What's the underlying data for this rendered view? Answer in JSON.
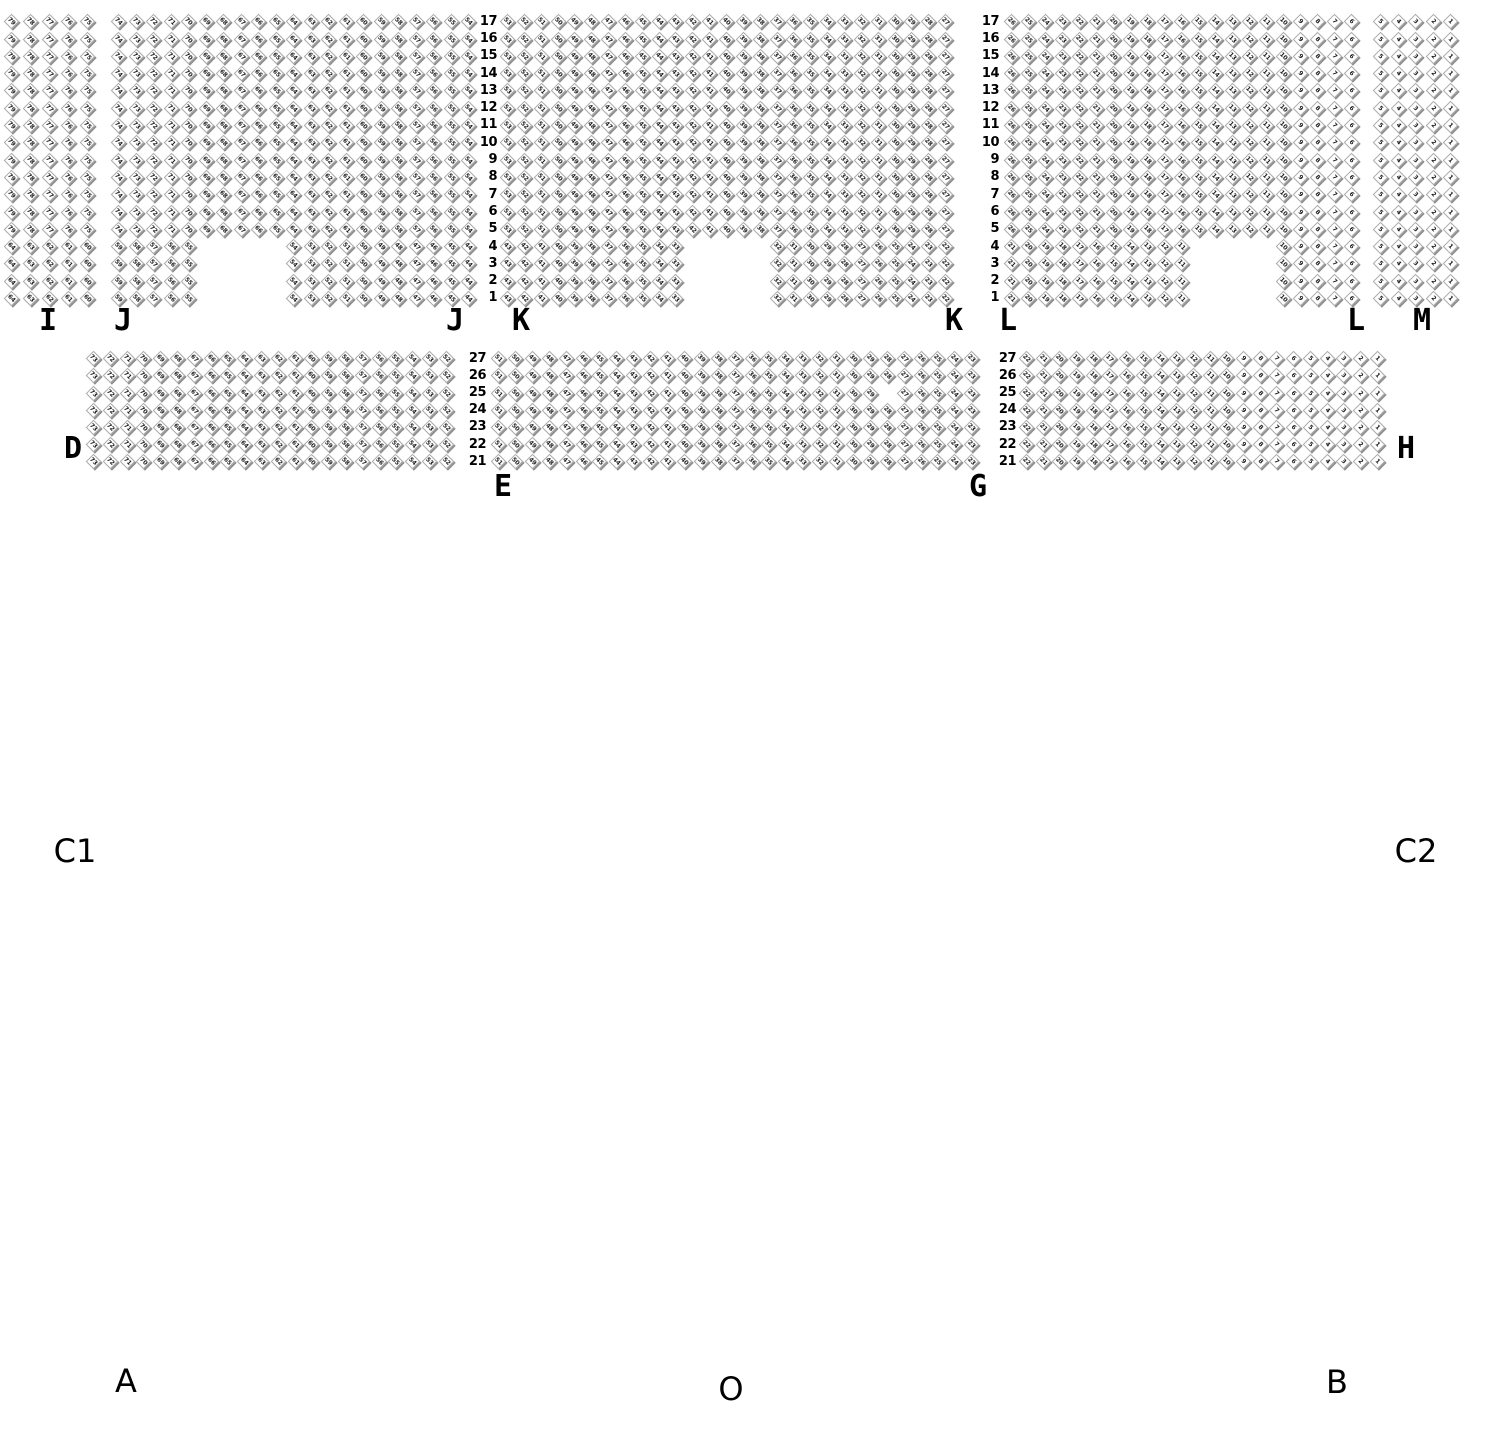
{
  "canvas": {
    "width": 1490,
    "height": 1430,
    "background": "#ffffff"
  },
  "seat_style": {
    "fill": "#ffffff",
    "border_color": "#ababab",
    "shadow_color": "#8f8f8f",
    "number_color": "#1c1c1c"
  },
  "groups": [
    {
      "name": "upper-tier",
      "top": 13,
      "cell_h": 17.3,
      "row_labels": [
        17,
        16,
        15,
        14,
        13,
        12,
        11,
        10,
        9,
        8,
        7,
        6,
        5,
        4,
        3,
        2,
        1
      ],
      "label_columns": [
        {
          "right": 497
        },
        {
          "right": 999
        }
      ],
      "blocks": [
        {
          "name": "I",
          "left": 2,
          "cell_w": 19.0,
          "cols": 5,
          "plans": [
            {
              "rows": [
                17,
                5
              ],
              "segments": [
                [
                  1,
                  79,
                  5
                ]
              ]
            },
            {
              "rows": [
                4,
                1
              ],
              "segments": [
                [
                  1,
                  64,
                  5
                ]
              ]
            }
          ]
        },
        {
          "name": "J",
          "left": 110,
          "cell_w": 17.5,
          "cols": 21,
          "plans": [
            {
              "rows": [
                17,
                5
              ],
              "segments": [
                [
                  1,
                  74,
                  21
                ]
              ]
            },
            {
              "rows": [
                4,
                1
              ],
              "segments": [
                [
                  1,
                  59,
                  5
                ],
                [
                  11,
                  54,
                  11
                ]
              ]
            }
          ]
        },
        {
          "name": "K",
          "left": 499,
          "cell_w": 16.85,
          "cols": 27,
          "plans": [
            {
              "rows": [
                17,
                5
              ],
              "segments": [
                [
                  1,
                  53,
                  27
                ]
              ]
            },
            {
              "rows": [
                4,
                1
              ],
              "segments": [
                [
                  1,
                  43,
                  11
                ],
                [
                  17,
                  32,
                  11
                ]
              ]
            }
          ]
        },
        {
          "name": "L",
          "left": 1003,
          "cell_w": 17.0,
          "cols": 21,
          "plans": [
            {
              "rows": [
                17,
                5
              ],
              "segments": [
                [
                  1,
                  26,
                  21
                ]
              ]
            },
            {
              "rows": [
                4,
                1
              ],
              "segments": [
                [
                  1,
                  21,
                  11
                ],
                [
                  17,
                  10,
                  5
                ]
              ]
            }
          ]
        },
        {
          "name": "M",
          "left": 1372,
          "cell_w": 17.5,
          "cols": 5,
          "plans": [
            {
              "rows": [
                17,
                1
              ],
              "segments": [
                [
                  1,
                  5,
                  5
                ]
              ]
            }
          ]
        }
      ]
    },
    {
      "name": "rear-tier",
      "top": 350,
      "cell_h": 17.2,
      "row_labels": [
        27,
        26,
        25,
        24,
        23,
        22,
        21
      ],
      "label_columns": [
        {
          "right": 486
        },
        {
          "right": 1016
        }
      ],
      "blocks": [
        {
          "name": "D",
          "left": 85,
          "cell_w": 16.8,
          "cols": 22,
          "plans": [
            {
              "rows": [
                27,
                21
              ],
              "segments": [
                [
                  1,
                  73,
                  22
                ]
              ]
            }
          ]
        },
        {
          "name": "E",
          "left": 490,
          "cell_w": 16.9,
          "cols": 29,
          "plans": [
            {
              "rows": [
                27,
                21
              ],
              "segments": [
                [
                  1,
                  51,
                  29
                ]
              ]
            }
          ],
          "missing": [
            {
              "row": 25,
              "seat": 28
            }
          ]
        },
        {
          "name": "G",
          "left": 1018,
          "cell_w": 16.7,
          "cols": 22,
          "plans": [
            {
              "rows": [
                27,
                21
              ],
              "segments": [
                [
                  1,
                  22,
                  22
                ]
              ]
            }
          ]
        }
      ]
    }
  ],
  "section_labels": [
    {
      "id": "i",
      "text": "I",
      "x": 48,
      "y": 321
    },
    {
      "id": "j-left",
      "text": "J",
      "x": 123,
      "y": 321
    },
    {
      "id": "j-right",
      "text": "J",
      "x": 455,
      "y": 321
    },
    {
      "id": "k-left",
      "text": "K",
      "x": 521,
      "y": 321
    },
    {
      "id": "k-right",
      "text": "K",
      "x": 954,
      "y": 321
    },
    {
      "id": "l-left",
      "text": "L",
      "x": 1008,
      "y": 321
    },
    {
      "id": "l-right",
      "text": "L",
      "x": 1356,
      "y": 321
    },
    {
      "id": "m",
      "text": "M",
      "x": 1422,
      "y": 321
    },
    {
      "id": "d",
      "text": "D",
      "x": 73,
      "y": 449
    },
    {
      "id": "e",
      "text": "E",
      "x": 503,
      "y": 487
    },
    {
      "id": "g",
      "text": "G",
      "x": 978,
      "y": 487
    },
    {
      "id": "h",
      "text": "H",
      "x": 1406,
      "y": 449
    }
  ],
  "zone_labels": [
    {
      "id": "c1",
      "text": "C1",
      "x": 75,
      "y": 851
    },
    {
      "id": "c2",
      "text": "C2",
      "x": 1416,
      "y": 851
    },
    {
      "id": "a",
      "text": "A",
      "x": 126,
      "y": 1381
    },
    {
      "id": "o",
      "text": "O",
      "x": 731,
      "y": 1389
    },
    {
      "id": "b",
      "text": "B",
      "x": 1337,
      "y": 1382
    }
  ]
}
